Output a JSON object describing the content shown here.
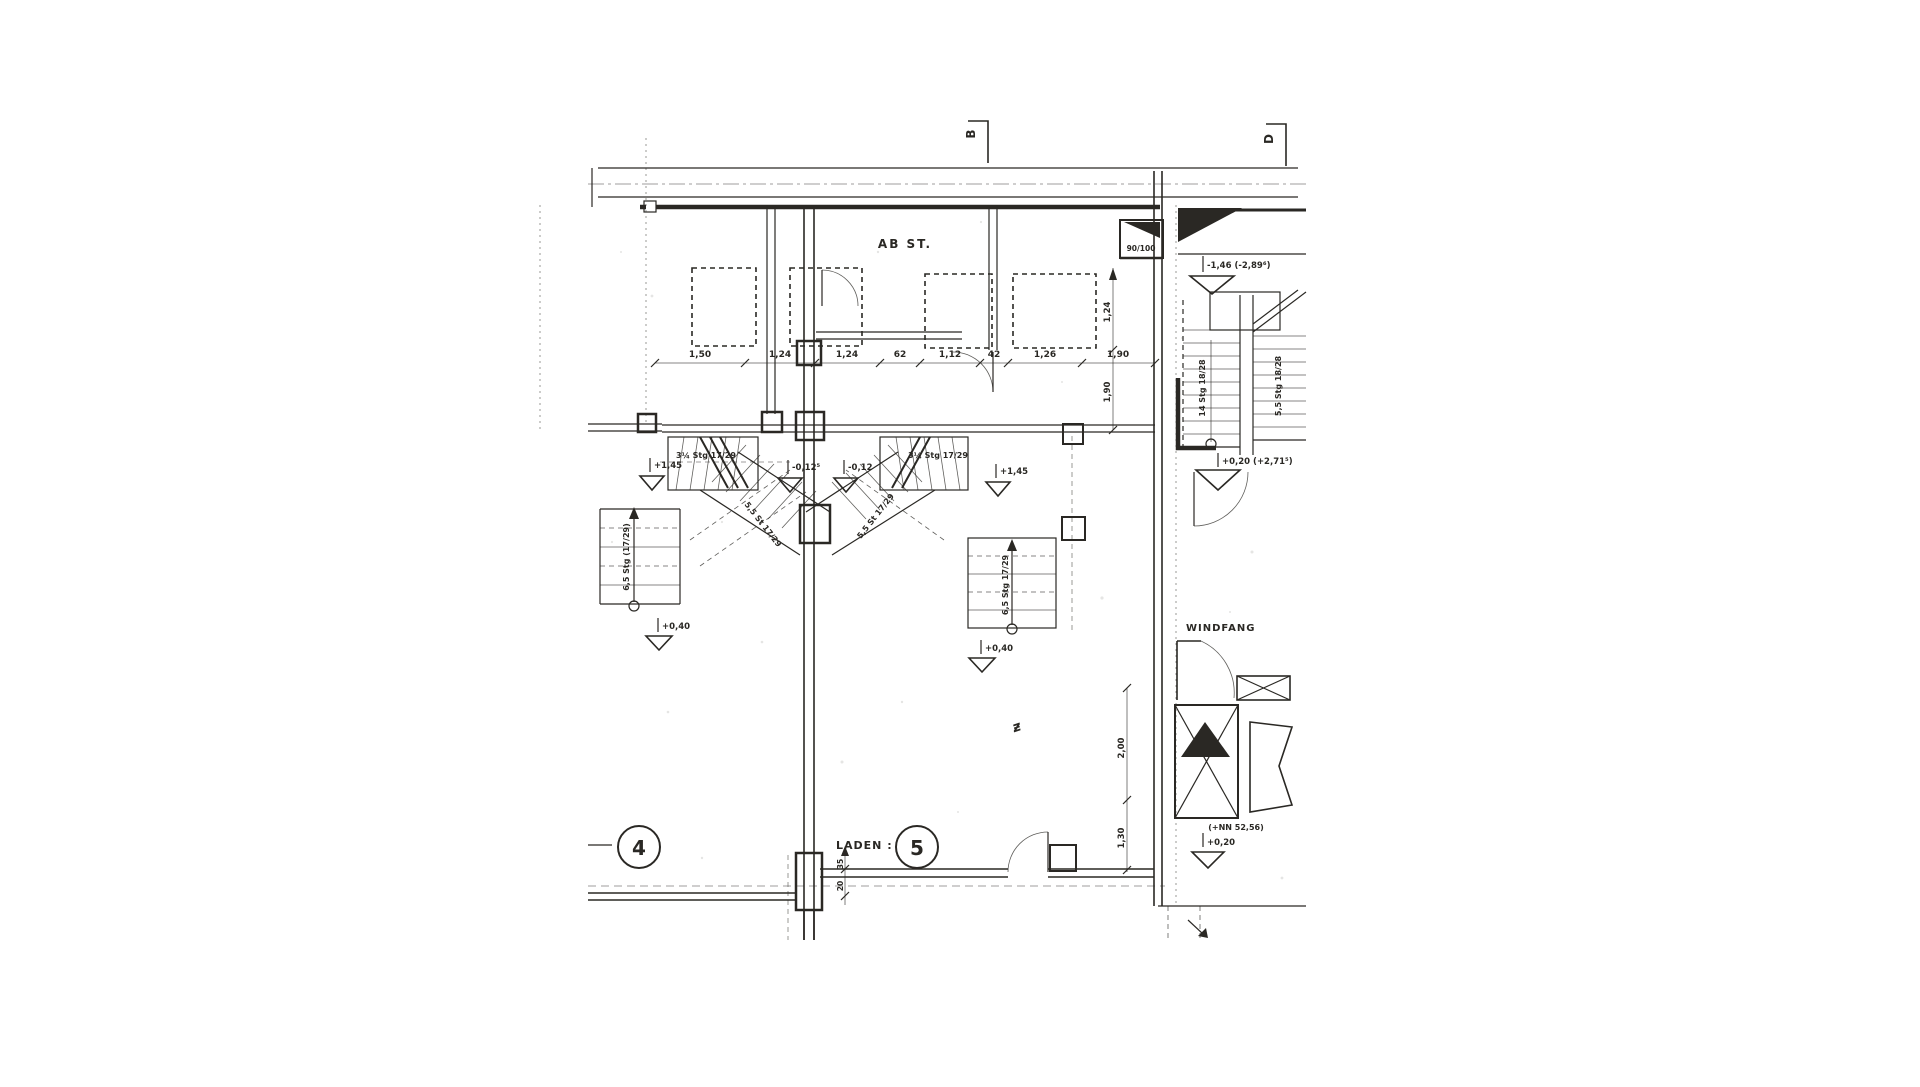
{
  "colors": {
    "ink": "#2a2824",
    "paper": "#ffffff"
  },
  "section_markers": {
    "b": "B",
    "d": "D"
  },
  "rooms": {
    "abst": "AB ST.",
    "windfang": "WINDFANG",
    "laden_label": "LADEN :",
    "laden_number": "5",
    "unit_left_number": "4"
  },
  "duct_label": "90/100",
  "levels": {
    "upper_right": "-1,46 (-2,89⁶)",
    "stair_mid": "+0,20 (+2,71⁵)",
    "plus_145_left": "+1,45",
    "plus_145_right": "+1,45",
    "minus_012_left": "-0,12⁵",
    "minus_012_right": "-0,12",
    "plus_040_left": "+0,40",
    "plus_040_mid": "+0,40",
    "entrance": "+0,20",
    "nn": "(+NN 52,56)"
  },
  "stairs": {
    "right_flight_a": "14 Stg 18/28",
    "right_flight_b": "5,5 Stg 18/28",
    "winder_left": "3¼ Stg 17/29",
    "winder_right": "3¼ Stg 17/29",
    "diag_left": "5,5 St 17/29",
    "diag_right": "5,5 St 17/29",
    "straight_left": "6,5 Stg (17/29)",
    "straight_mid": "6,5 Stg 17/29"
  },
  "dimensions": {
    "top_chain": [
      "1,50",
      "1,24",
      "1,24",
      "62",
      "1,12",
      "42",
      "1,26",
      "1,90"
    ],
    "v_124": "1,24",
    "v_190": "1,90",
    "v_200": "2,00",
    "v_130": "1,30",
    "w_35": "35",
    "w_20": "20"
  },
  "marks": {
    "squiggle": "ƶ"
  }
}
